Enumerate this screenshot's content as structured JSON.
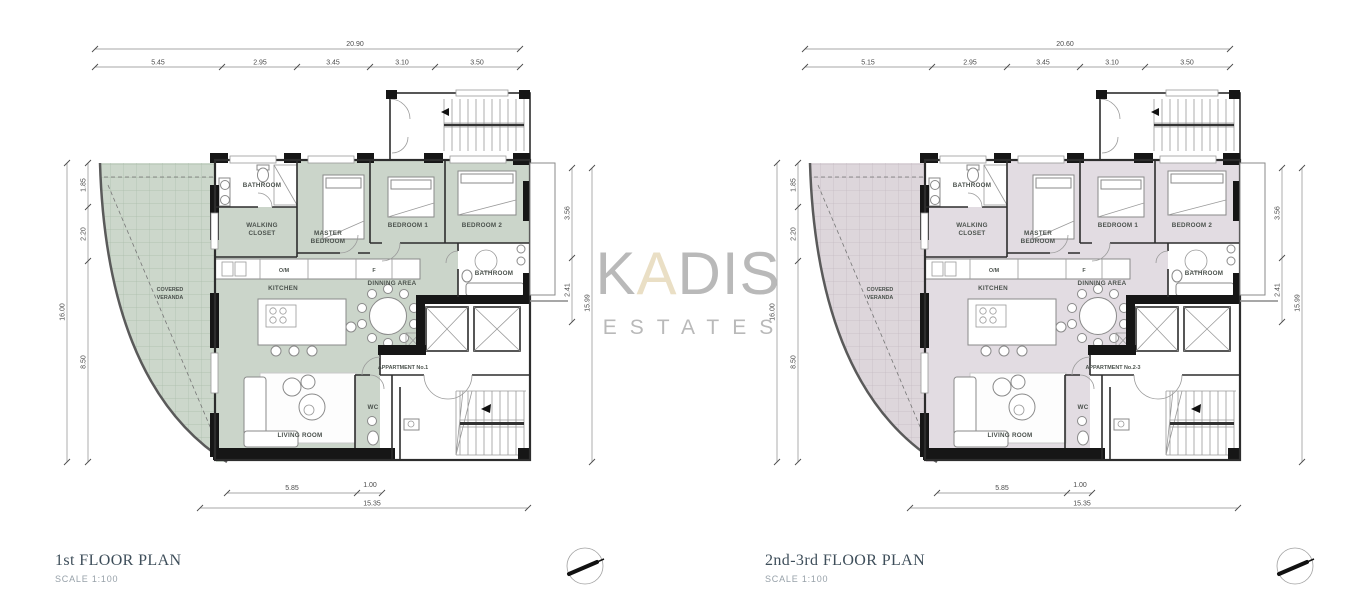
{
  "watermark": {
    "part1": "K",
    "part2": "A",
    "part3": "DIS",
    "subtitle": "ESTATES"
  },
  "plans": [
    {
      "title": "1st FLOOR PLAN",
      "scale_label": "SCALE 1:100",
      "apartment_label": "APPARTMENT No.1",
      "rooms": {
        "bathroom_top": "BATHROOM",
        "walking_closet_l1": "WALKING",
        "walking_closet_l2": "CLOSET",
        "master_l1": "MASTER",
        "master_l2": "BEDROOM",
        "bedroom1": "BEDROOM 1",
        "bedroom2": "BEDROOM 2",
        "bathroom_mid": "BATHROOM",
        "kitchen": "KITCHEN",
        "dining": "DINNING AREA",
        "living": "LIVING ROOM",
        "wc": "WC",
        "veranda_l1": "COVERED",
        "veranda_l2": "VERANDA",
        "counter_om": "O/M",
        "counter_f": "F"
      },
      "dims": {
        "top_total": "20.90",
        "top_segments": [
          "5.45",
          "2.95",
          "3.45",
          "3.10",
          "3.50"
        ],
        "left_total": "16.00",
        "left_segments": [
          "1.85",
          "2.20",
          "8.50"
        ],
        "right_total": "15.99",
        "right_segments": [
          "3.56",
          "2.41"
        ],
        "bottom_segments": [
          "5.85",
          "1.00"
        ],
        "bottom_total": "15.35"
      },
      "colors": {
        "room_fill": "#cbd5ca",
        "veranda_fill": "#ccd7cb",
        "veranda_grid": "#aabdaa"
      }
    },
    {
      "title": "2nd-3rd FLOOR PLAN",
      "scale_label": "SCALE 1:100",
      "apartment_label": "APPARTMENT No.2-3",
      "rooms": {
        "bathroom_top": "BATHROOM",
        "walking_closet_l1": "WALKING",
        "walking_closet_l2": "CLOSET",
        "master_l1": "MASTER",
        "master_l2": "BEDROOM",
        "bedroom1": "BEDROOM 1",
        "bedroom2": "BEDROOM 2",
        "bathroom_mid": "BATHROOM",
        "kitchen": "KITCHEN",
        "dining": "DINNING AREA",
        "living": "LIVING ROOM",
        "wc": "WC",
        "veranda_l1": "COVERED",
        "veranda_l2": "VERANDA",
        "counter_om": "O/M",
        "counter_f": "F"
      },
      "dims": {
        "top_total": "20.60",
        "top_segments": [
          "5.15",
          "2.95",
          "3.45",
          "3.10",
          "3.50"
        ],
        "left_total": "16.00",
        "left_segments": [
          "1.85",
          "2.20",
          "8.50"
        ],
        "right_total": "15.99",
        "right_segments": [
          "3.56",
          "2.41"
        ],
        "bottom_segments": [
          "5.85",
          "1.00"
        ],
        "bottom_total": "15.35"
      },
      "colors": {
        "room_fill": "#e2dce2",
        "veranda_fill": "#ddd6db",
        "veranda_grid": "#c4bac2"
      }
    }
  ]
}
